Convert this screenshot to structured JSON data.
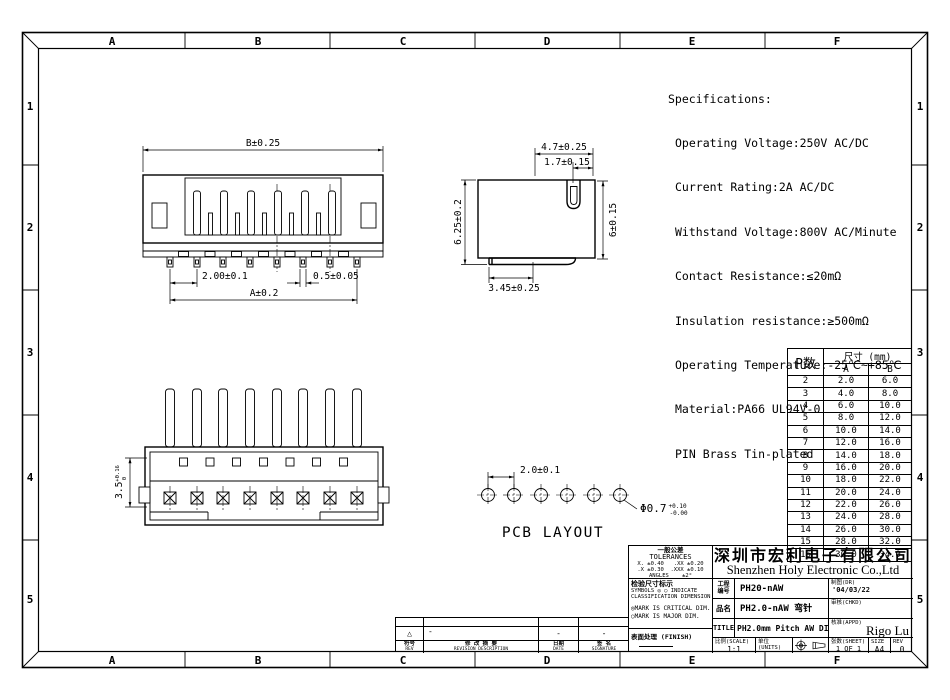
{
  "frame": {
    "columns": [
      "A",
      "B",
      "C",
      "D",
      "E",
      "F"
    ],
    "rows": [
      "1",
      "2",
      "3",
      "4",
      "5"
    ]
  },
  "specifications": {
    "title": "Specifications:",
    "lines": [
      "Operating Voltage:250V AC/DC",
      "Current Rating:2A AC/DC",
      "Withstand Voltage:800V AC/Minute",
      "Contact Resistance:≤20mΩ",
      "Insulation resistance:≥500mΩ",
      "Operating Temperature:-25℃~+85℃",
      "Material:PA66 UL94V-0",
      "PIN Brass Tin-plated"
    ]
  },
  "views": {
    "front": {
      "dim_width_b": "B±0.25",
      "dim_pitch": "2.00±0.1",
      "dim_pin_width": "0.5±0.05",
      "dim_width_a": "A±0.2"
    },
    "side": {
      "dim_top": "4.7±0.25",
      "dim_pin_offset": "1.7±0.15",
      "dim_height_left": "6.25±0.2",
      "dim_height_right": "6±0.15",
      "dim_bottom": "3.45±0.25"
    },
    "bottom": {
      "dim_height": "3.5",
      "tol_upper": "+0.16",
      "tol_lower": "0"
    },
    "pcb": {
      "label": "PCB LAYOUT",
      "dim_pitch": "2.0±0.1",
      "dim_hole_dia": "Φ0.7",
      "tol_upper": "+0.10",
      "tol_lower": "-0.00"
    }
  },
  "size_table": {
    "header_p": "P数",
    "header_dim": "尺寸 (mm)",
    "header_a": "A",
    "header_b": "B",
    "rows": [
      [
        "2",
        "2.0",
        "6.0"
      ],
      [
        "3",
        "4.0",
        "8.0"
      ],
      [
        "4",
        "6.0",
        "10.0"
      ],
      [
        "5",
        "8.0",
        "12.0"
      ],
      [
        "6",
        "10.0",
        "14.0"
      ],
      [
        "7",
        "12.0",
        "16.0"
      ],
      [
        "8",
        "14.0",
        "18.0"
      ],
      [
        "9",
        "16.0",
        "20.0"
      ],
      [
        "10",
        "18.0",
        "22.0"
      ],
      [
        "11",
        "20.0",
        "24.0"
      ],
      [
        "12",
        "22.0",
        "26.0"
      ],
      [
        "13",
        "24.0",
        "28.0"
      ],
      [
        "14",
        "26.0",
        "30.0"
      ],
      [
        "15",
        "28.0",
        "32.0"
      ],
      [
        "16",
        "30.0",
        "34.0"
      ]
    ]
  },
  "title_block": {
    "tolerance": {
      "title_cn": "一般公差",
      "title_en": "TOLERANCES",
      "line1": "X. ±0.40   .XX ±0.20",
      "line2": ".X ±0.30  .XXX ±0.10",
      "line3": "ANGLES    ±2°"
    },
    "inspection": {
      "label_cn": "检验尺寸标示",
      "symbols_line1": "SYMBOLS ◎ ○ INDICATE",
      "symbols_line2": "CLASSIFICATION DIMENSION",
      "mark_critical": "◎MARK IS CRITICAL DIM.",
      "mark_major": "○MARK IS MAJOR DIM."
    },
    "finish_label": "表面处理 (FINISH)",
    "company_cn": "深圳市宏利电子有限公司",
    "company_en": "Shenzhen Holy Electronic Co.,Ltd",
    "part_no": {
      "label_line1": "工程",
      "label_line2": "编号",
      "value": "PH20-nAW"
    },
    "product": {
      "label": "品名",
      "value": "PH2.0-nAW 弯针"
    },
    "title_row": {
      "label": "TITLE",
      "value": "PH2.0mm  Pitch AW DIP CONN"
    },
    "drawn": {
      "label": "制图(DR)",
      "value": "'04/03/22"
    },
    "checked": {
      "label": "审核(CHKD)",
      "value": ""
    },
    "approved": {
      "label": "核准(APPD)",
      "value": "Rigo Lu"
    },
    "scale": {
      "label": "比例(SCALE)",
      "value": "1:1"
    },
    "units": {
      "label": "单位(UNITS)",
      "value": "mm"
    },
    "sheet": {
      "label": "张数(SHEET)",
      "value": "1 OF 1"
    },
    "size": {
      "label": "SIZE",
      "value": "A4"
    },
    "rev": {
      "label": "REV",
      "value": "0"
    }
  },
  "revision_strip": {
    "triangle": "△",
    "desc_dash": "-",
    "date_dash": "-",
    "sig_dash": "-",
    "col_rev_cn": "符号",
    "col_rev_en": "REV",
    "col_desc_cn": "修 改 摘 要",
    "col_desc_en": "REVISION DESCRIPTION",
    "col_date_cn": "日期",
    "col_date_en": "DATE",
    "col_sig_cn": "签 名",
    "col_sig_en": "SIGNATURE"
  }
}
